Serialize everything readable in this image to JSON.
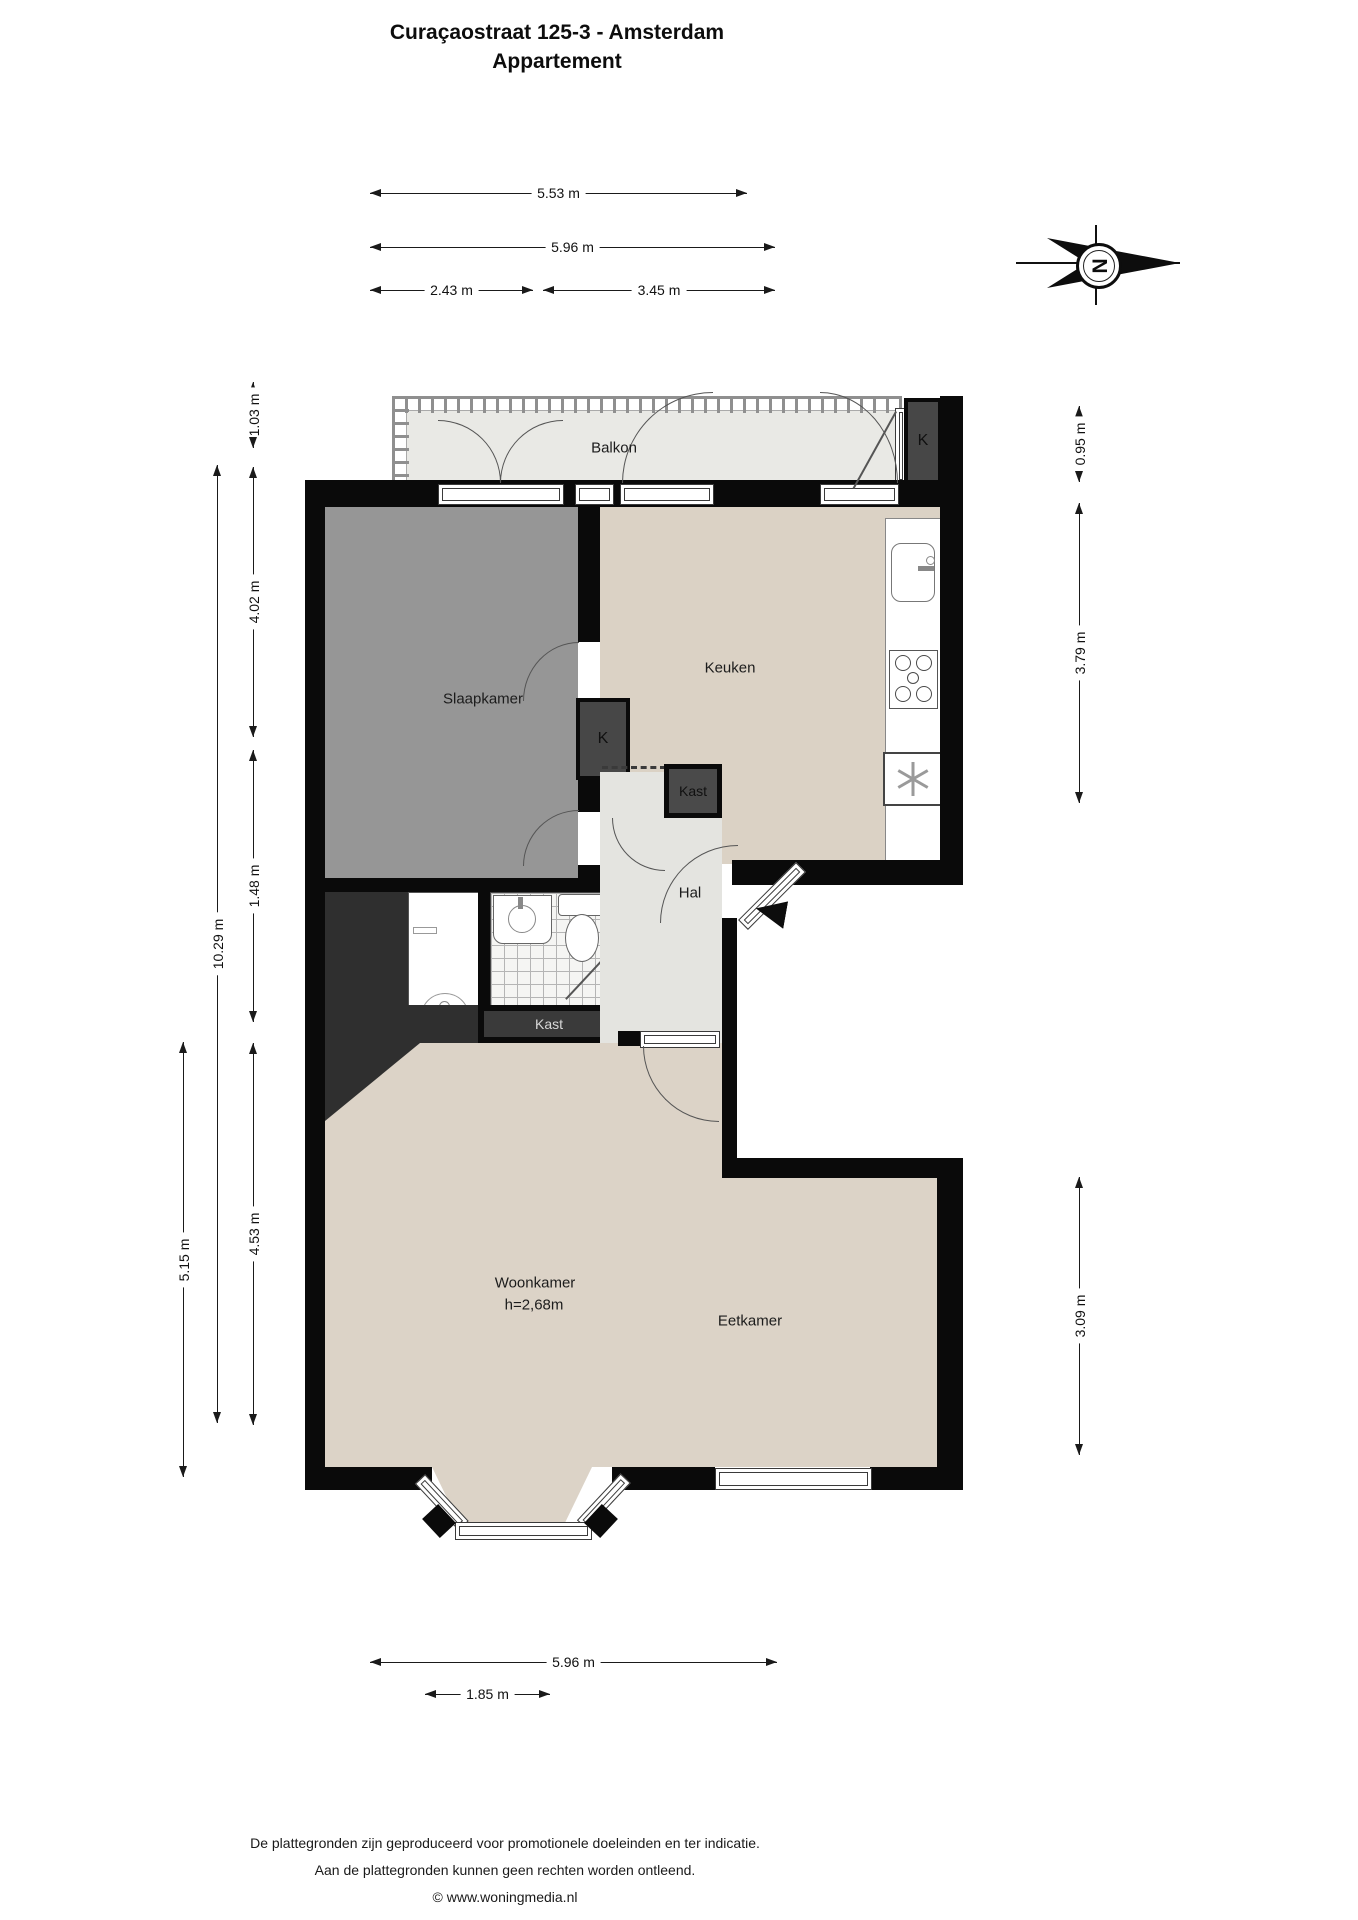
{
  "title": {
    "line1": "Curaçaostraat 125-3 - Amsterdam",
    "line2": "Appartement"
  },
  "compass": {
    "letter": "N"
  },
  "rooms": {
    "balkon": {
      "label": "Balkon"
    },
    "balkon_kast": {
      "label": "K"
    },
    "slaapkamer": {
      "label": "Slaapkamer"
    },
    "keuken": {
      "label": "Keuken"
    },
    "kast_k": {
      "label": "K"
    },
    "kast_keuken": {
      "label": "Kast"
    },
    "hal": {
      "label": "Hal"
    },
    "kast_hal": {
      "label": "Kast"
    },
    "woonkamer": {
      "label": "Woonkamer",
      "height_note": "h=2,68m"
    },
    "eetkamer": {
      "label": "Eetkamer"
    }
  },
  "dimensions": {
    "top": [
      {
        "label": "5.53 m"
      },
      {
        "label": "5.96 m"
      },
      {
        "label": "2.43 m"
      },
      {
        "label": "3.45 m"
      }
    ],
    "left": [
      {
        "label": "1.03 m"
      },
      {
        "label": "4.02 m"
      },
      {
        "label": "1.48 m"
      },
      {
        "label": "4.53 m"
      },
      {
        "label": "10.29 m"
      },
      {
        "label": "5.15 m"
      }
    ],
    "right": [
      {
        "label": "0.95 m"
      },
      {
        "label": "3.79 m"
      },
      {
        "label": "3.09 m"
      }
    ],
    "bottom": [
      {
        "label": "5.96 m"
      },
      {
        "label": "1.85 m"
      }
    ]
  },
  "footer": {
    "line1": "De plattegronden zijn geproduceerd voor promotionele doeleinden en ter indicatie.",
    "line2": "Aan de plattegronden kunnen geen rechten worden ontleend.",
    "line3": "© www.woningmedia.nl"
  },
  "colors": {
    "wall": "#0a0a0a",
    "bedroom_floor": "#969696",
    "living_floor": "#dcd3c7",
    "kitchen_floor": "#dbd2c5",
    "balcony_floor": "#e9e9e5",
    "hall_floor": "#e4e4e0",
    "closet_dark": "#474747"
  }
}
